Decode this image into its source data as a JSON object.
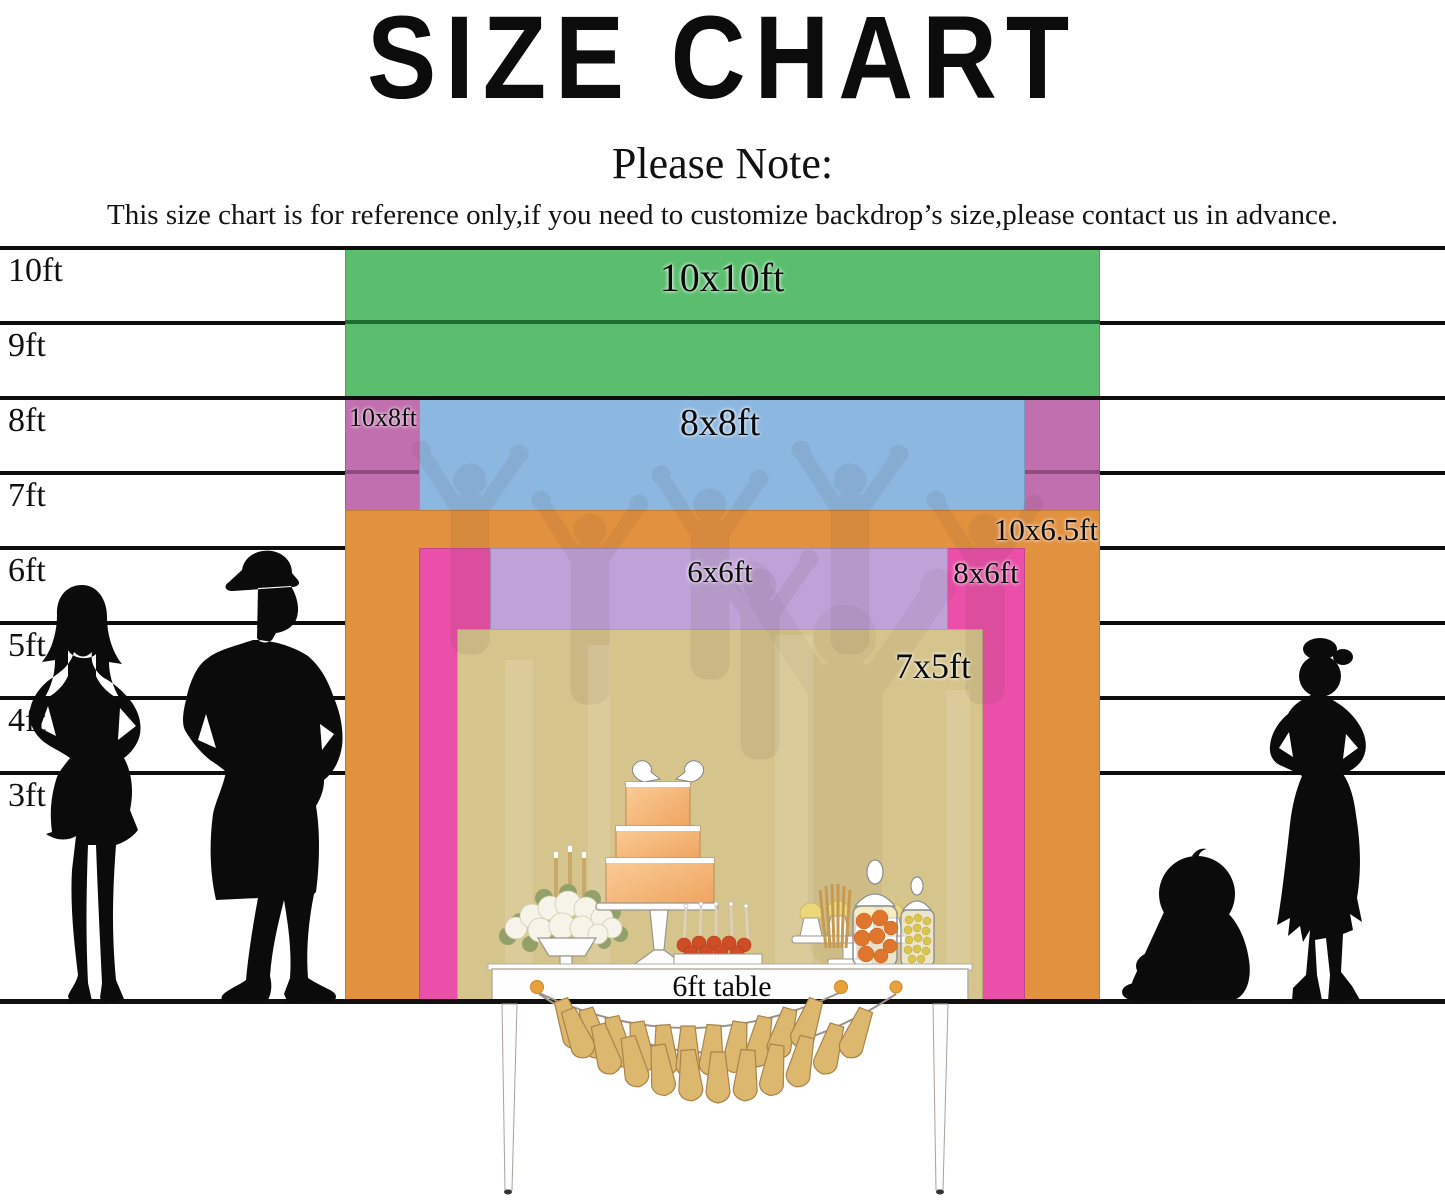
{
  "title": "SIZE CHART",
  "note": {
    "heading": "Please Note:",
    "body": "This size chart is for reference only,if you need to customize backdrop’s size,please contact us in advance."
  },
  "ruler_labels": [
    "10ft",
    "9ft",
    "8ft",
    "7ft",
    "6ft",
    "5ft",
    "4ft",
    "3ft"
  ],
  "backdrop_sizes": [
    {
      "label": "10x10ft",
      "width_ft": 10,
      "height_ft": 10,
      "color": "#5abe6e"
    },
    {
      "label": "10x8ft",
      "width_ft": 10,
      "height_ft": 8,
      "color": "#c16fae"
    },
    {
      "label": "8x8ft",
      "width_ft": 8,
      "height_ft": 8,
      "color": "#8cb7e0"
    },
    {
      "label": "10x6.5ft",
      "width_ft": 10,
      "height_ft": 6.5,
      "color": "#e2913f"
    },
    {
      "label": "8x6ft",
      "width_ft": 8,
      "height_ft": 6,
      "color": "#ea4fa9"
    },
    {
      "label": "6x6ft",
      "width_ft": 6,
      "height_ft": 6,
      "color": "#bfa2d8"
    },
    {
      "label": "7x5ft",
      "width_ft": 7,
      "height_ft": 5,
      "color": "#d6c48d"
    }
  ],
  "table_label": "6ft table",
  "palette": {
    "line": "#0d0d0d",
    "nine_ft_over_green": "rgba(16,86,38,0.8)",
    "seven_ft_over_magenta": "rgba(96,40,84,0.5)",
    "tassel": "#dcb76e",
    "tassel_edge": "#a9834a",
    "garland_dot": "#e8a13c",
    "cake_light": "#fac693",
    "cake_dark": "#f0a660",
    "pop_orange": "#ce4d26",
    "candy_orange": "#e0762e",
    "candy_yellow": "#d9c64e",
    "leaf_green": "#93a06a",
    "silhouette": "#0b0b0b"
  }
}
